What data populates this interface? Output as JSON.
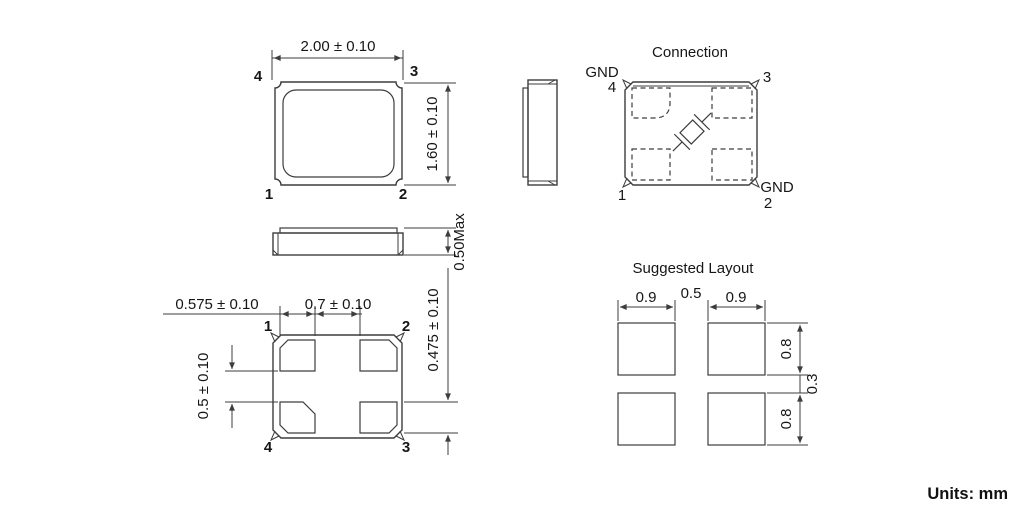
{
  "footer": {
    "units_note": "Units: mm"
  },
  "top_view": {
    "width_dim": "2.00 ± 0.10",
    "height_dim": "1.60 ± 0.10",
    "pin_top_left": "4",
    "pin_top_right": "3",
    "pin_bottom_left": "1",
    "pin_bottom_right": "2"
  },
  "side_view": {
    "height_dim": "0.50Max"
  },
  "bottom_view": {
    "pad_width_dim": "0.575 ± 0.10",
    "pad_gap_dim": "0.7 ± 0.10",
    "pad_height_dim": "0.475 ± 0.10",
    "pad_vgap_dim": "0.5 ± 0.10",
    "pin_top_left": "1",
    "pin_top_right": "2",
    "pin_bottom_left": "4",
    "pin_bottom_right": "3"
  },
  "connection": {
    "title": "Connection",
    "gnd_top": "GND",
    "pin4": "4",
    "pin3": "3",
    "pin1": "1",
    "gnd_bottom": "GND",
    "pin2": "2"
  },
  "layout": {
    "title": "Suggested Layout",
    "pad_w_left": "0.9",
    "gap_h": "0.5",
    "pad_w_right": "0.9",
    "pad_h_top": "0.8",
    "gap_v": "0.3",
    "pad_h_bottom": "0.8"
  }
}
